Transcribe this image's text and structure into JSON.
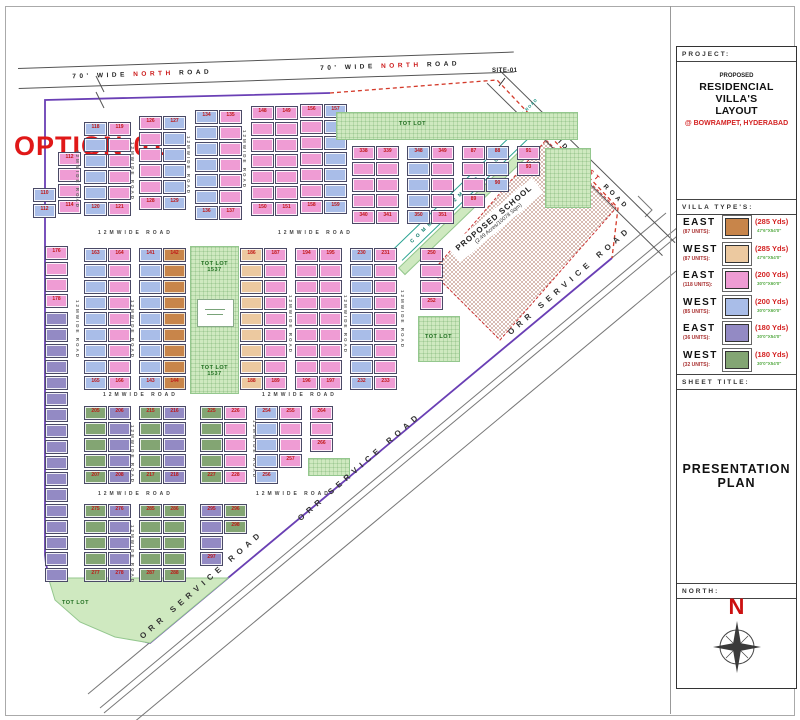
{
  "page": {
    "option_label": "OPTION-01",
    "site_label": "SITE-01"
  },
  "roads": {
    "north": {
      "pre": "70' WIDE ",
      "hl": "NORTH",
      "post": " ROAD"
    },
    "east": {
      "pre": "70' WIDE ",
      "hl": "EAST",
      "post": " ROAD"
    },
    "orr_text": "ORR SERVICE ROAD",
    "common_text": "COMMON 12MWIDE ROAD",
    "internal_text": "12MWIDE ROAD",
    "orr_labels": [
      {
        "x": 138,
        "y": 634
      },
      {
        "x": 296,
        "y": 516
      },
      {
        "x": 506,
        "y": 330
      }
    ],
    "h_labels": [
      {
        "x": 98,
        "y": 230
      },
      {
        "x": 278,
        "y": 230
      },
      {
        "x": 103,
        "y": 392
      },
      {
        "x": 262,
        "y": 392
      },
      {
        "x": 98,
        "y": 491
      },
      {
        "x": 256,
        "y": 491
      }
    ],
    "v_labels": [
      {
        "x": 75,
        "y": 150
      },
      {
        "x": 130,
        "y": 142
      },
      {
        "x": 186,
        "y": 136
      },
      {
        "x": 242,
        "y": 130
      },
      {
        "x": 75,
        "y": 300
      },
      {
        "x": 130,
        "y": 300
      },
      {
        "x": 288,
        "y": 295
      },
      {
        "x": 343,
        "y": 295
      },
      {
        "x": 400,
        "y": 290
      },
      {
        "x": 130,
        "y": 425
      },
      {
        "x": 252,
        "y": 420
      },
      {
        "x": 130,
        "y": 525
      }
    ]
  },
  "school": {
    "name": "PROPOSED SCHOOL",
    "area": "(2.49 Acres/10078 Sqm)"
  },
  "tot_lot": {
    "text": "TOT LOT",
    "center_line1": "TOT LOT",
    "center_line2": "1537"
  },
  "plan": {
    "blocks": [
      {
        "x": 33,
        "y": 188,
        "cols": [
          "blue"
        ],
        "rows": 2,
        "num": 110
      },
      {
        "x": 58,
        "y": 152,
        "cols": [
          "pink"
        ],
        "rows": 4,
        "num": 112
      },
      {
        "x": 84,
        "y": 122,
        "cols": [
          "blue",
          "pink"
        ],
        "rows": 6,
        "num": 118
      },
      {
        "x": 139,
        "y": 116,
        "cols": [
          "pink",
          "blue"
        ],
        "rows": 6,
        "num": 126
      },
      {
        "x": 195,
        "y": 110,
        "cols": [
          "blue",
          "pink"
        ],
        "rows": 7,
        "num": 134
      },
      {
        "x": 251,
        "y": 106,
        "cols": [
          "pink",
          "pink"
        ],
        "rows": 7,
        "num": 148
      },
      {
        "x": 300,
        "y": 104,
        "cols": [
          "pink",
          "blue"
        ],
        "rows": 7,
        "num": 156
      },
      {
        "x": 352,
        "y": 146,
        "cols": [
          "pink",
          "pink"
        ],
        "rows": 5,
        "num": 338
      },
      {
        "x": 407,
        "y": 146,
        "cols": [
          "blue",
          "pink"
        ],
        "rows": 5,
        "num": 348
      },
      {
        "x": 462,
        "y": 146,
        "cols": [
          "pink",
          "blue"
        ],
        "colRows": [
          4,
          3
        ],
        "num": 87
      },
      {
        "x": 517,
        "y": 146,
        "cols": [
          "pink"
        ],
        "rows": 2,
        "num": 91
      },
      {
        "x": 548,
        "y": 152,
        "cols": [
          "blue"
        ],
        "rows": 2,
        "num": 81
      },
      {
        "x": 45,
        "y": 246,
        "cols": [
          "pink"
        ],
        "rows": 4,
        "num": 176
      },
      {
        "x": 45,
        "y": 312,
        "cols": [
          "purple"
        ],
        "rows": 17
      },
      {
        "x": 84,
        "y": 248,
        "cols": [
          "blue",
          "pink"
        ],
        "rows": 9,
        "num": 163
      },
      {
        "x": 139,
        "y": 248,
        "cols": [
          "blue",
          "orange"
        ],
        "rows": 9,
        "num": 141
      },
      {
        "x": 240,
        "y": 248,
        "cols": [
          "tan",
          "pink"
        ],
        "rows": 9,
        "num": 186
      },
      {
        "x": 295,
        "y": 248,
        "cols": [
          "pink",
          "pink"
        ],
        "rows": 9,
        "num": 194
      },
      {
        "x": 350,
        "y": 248,
        "cols": [
          "blue",
          "pink"
        ],
        "rows": 9,
        "num": 230
      },
      {
        "x": 420,
        "y": 248,
        "cols": [
          "pink"
        ],
        "rows": 4,
        "num": 250
      },
      {
        "x": 84,
        "y": 406,
        "cols": [
          "green",
          "purple"
        ],
        "rows": 5,
        "num": 205
      },
      {
        "x": 139,
        "y": 406,
        "cols": [
          "green",
          "purple"
        ],
        "rows": 5,
        "num": 215
      },
      {
        "x": 200,
        "y": 406,
        "cols": [
          "green",
          "pink"
        ],
        "rows": 5,
        "num": 225
      },
      {
        "x": 255,
        "y": 406,
        "cols": [
          "blue",
          "pink"
        ],
        "colRows": [
          5,
          4
        ],
        "num": 254
      },
      {
        "x": 310,
        "y": 406,
        "cols": [
          "pink"
        ],
        "rows": 3,
        "num": 264
      },
      {
        "x": 84,
        "y": 504,
        "cols": [
          "green",
          "purple"
        ],
        "rows": 5,
        "num": 275
      },
      {
        "x": 139,
        "y": 504,
        "cols": [
          "green",
          "green"
        ],
        "rows": 5,
        "num": 285
      },
      {
        "x": 200,
        "y": 504,
        "cols": [
          "purple",
          "green"
        ],
        "colRows": [
          4,
          2
        ],
        "num": 295
      }
    ],
    "tot_rects": [
      {
        "x": 336,
        "y": 112,
        "w": 240,
        "h": 26,
        "lx": 62,
        "ly": 8,
        "label": true
      },
      {
        "x": 418,
        "y": 316,
        "w": 40,
        "h": 44,
        "lx": 6,
        "ly": 17,
        "label": true
      },
      {
        "x": 545,
        "y": 148,
        "w": 44,
        "h": 58,
        "label": false
      },
      {
        "x": 308,
        "y": 458,
        "w": 40,
        "h": 16,
        "label": false
      }
    ],
    "bottom_tot_label": {
      "x": 62,
      "y": 600
    }
  },
  "title_block": {
    "project_label": "PROJECT:",
    "project_line1": "PROPOSED",
    "project_line2": "RESIDENCIAL VILLA'S",
    "project_line3": "LAYOUT",
    "project_location": "@ BOWRAMPET, HYDERABAD",
    "villa_types_label": "VILLA TYPE'S:",
    "sheet_title_label": "SHEET TITLE:",
    "sheet_title": "PRESENTATION PLAN",
    "north_label": "NORTH:",
    "north_letter": "N"
  },
  "legend": {
    "rows": [
      {
        "dir": "EAST",
        "units": "(87 UNITS):",
        "yds": "(285 Yds)",
        "dims": "47'6\"X54'0\"",
        "color": "#c8854a"
      },
      {
        "dir": "WEST",
        "units": "(87 UNITS):",
        "yds": "(285 Yds)",
        "dims": "47'6\"X54'0\"",
        "color": "#ecc9a0"
      },
      {
        "dir": "EAST",
        "units": "(118 UNITS):",
        "yds": "(200 Yds)",
        "dims": "30'0\"X60'0\"",
        "color": "#ef9cd4"
      },
      {
        "dir": "WEST",
        "units": "(85 UNITS):",
        "yds": "(200 Yds)",
        "dims": "30'0\"X60'0\"",
        "color": "#a9bde8"
      },
      {
        "dir": "EAST",
        "units": "(36 UNITS):",
        "yds": "(180 Yds)",
        "dims": "30'0\"X54'0\"",
        "color": "#938ac4"
      },
      {
        "dir": "WEST",
        "units": "(32 UNITS):",
        "yds": "(180 Yds)",
        "dims": "30'0\"X54'0\"",
        "color": "#83a573"
      }
    ]
  },
  "colors": {
    "east_285": "#c8854a",
    "west_285": "#ecc9a0",
    "east_200": "#ef9cd4",
    "west_200": "#a9bde8",
    "east_180": "#938ac4",
    "west_180": "#83a573",
    "tot_lot": "#cfe9c0",
    "boundary": "#6a3fb5",
    "dashed_boundary": "#d43a2a",
    "accent_red": "#d42222",
    "legend_green": "#55aa44",
    "common_road_teal": "#2aa392"
  }
}
